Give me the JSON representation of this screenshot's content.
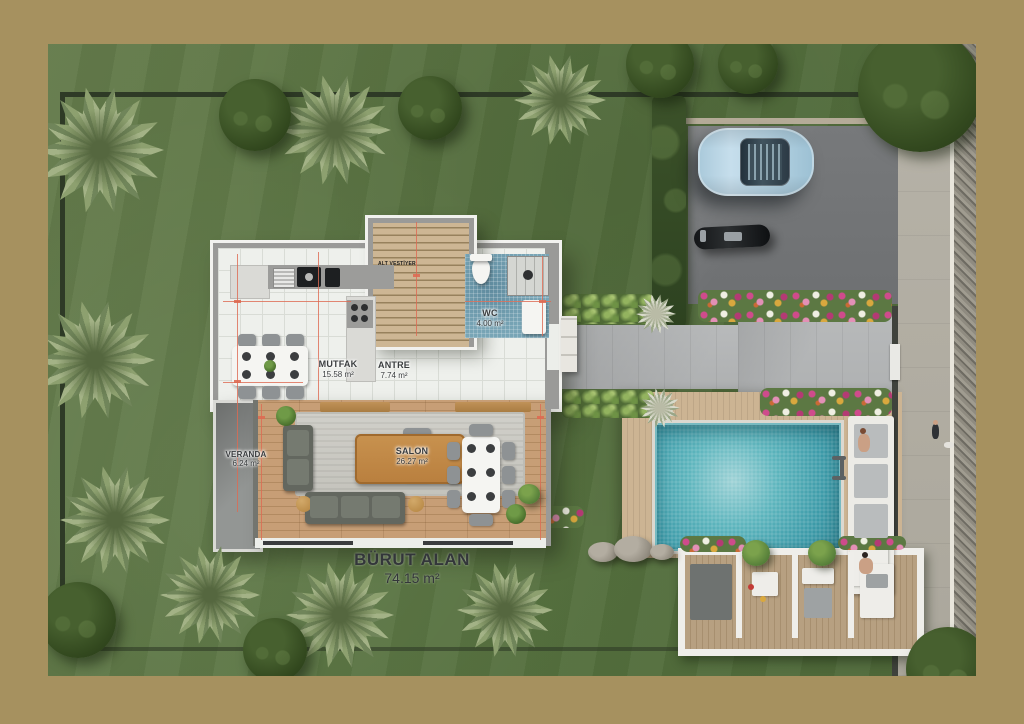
{
  "plan": {
    "rooms": [
      {
        "name": "MUTFAK",
        "area": "15.58 m²"
      },
      {
        "name": "ANTRE",
        "area": "7.74 m²"
      },
      {
        "name": "WC",
        "area": "4.00 m²"
      },
      {
        "name": "SALON",
        "area": "26.27 m²"
      },
      {
        "name": "VERANDA",
        "area": "6.24 m²"
      }
    ],
    "gross": {
      "label": "BÜRUT ALAN",
      "area": "74.15 m²"
    },
    "stair_note": "ALT VESTİYER"
  },
  "colors": {
    "frame_border": "#a6915f",
    "lawn_green": "#587340",
    "pool_teal": "#3c9aa8",
    "deck_wood": "#c4ad8d",
    "salon_wood": "#c79e76",
    "wall_grey": "#9a9a98",
    "dimension_red": "#dd6a52",
    "car_blue": "#b6d4e4",
    "driveway_grey": "#77797b"
  }
}
